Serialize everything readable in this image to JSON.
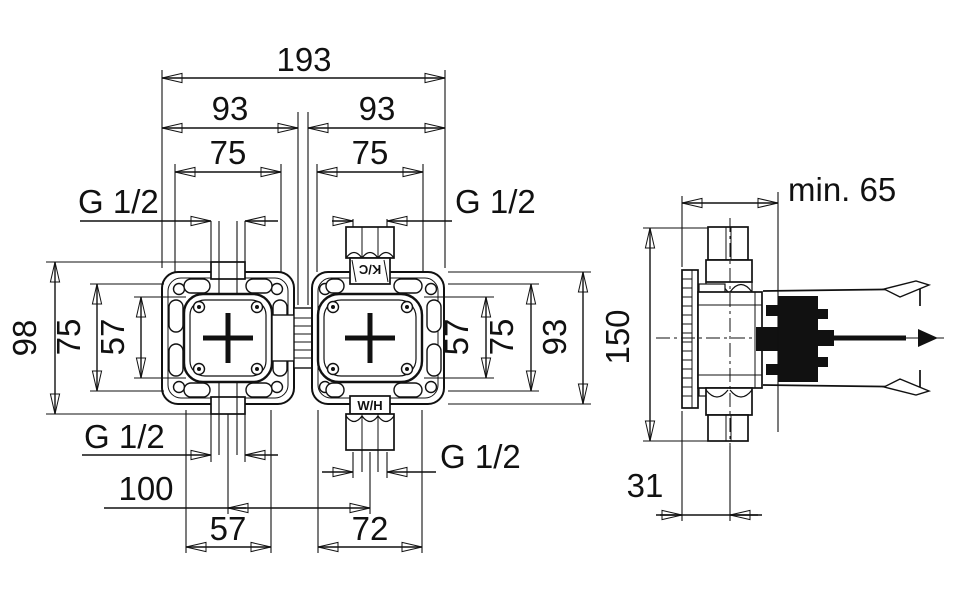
{
  "page": {
    "background": "#ffffff",
    "line_color": "#111111"
  },
  "front_view": {
    "width_total": "193",
    "width_left": "93",
    "width_right": "93",
    "pitch_left": "75",
    "pitch_right": "75",
    "thread_top_left": "G 1/2",
    "thread_top_right": "G 1/2",
    "thread_bottom_left": "G 1/2",
    "thread_bottom_right": "G 1/2",
    "height_outer_left": "98",
    "height_mid_left": "75",
    "height_inner_left": "57",
    "height_inner_right": "57",
    "height_mid_right": "75",
    "height_outer_right": "93",
    "port_spacing": "100",
    "body_width_left": "57",
    "body_width_right": "72",
    "marking_cold": "K/C",
    "marking_warm": "W/H"
  },
  "side_view": {
    "min_depth": "min. 65",
    "height_total": "150",
    "flange_to_axis": "31"
  }
}
